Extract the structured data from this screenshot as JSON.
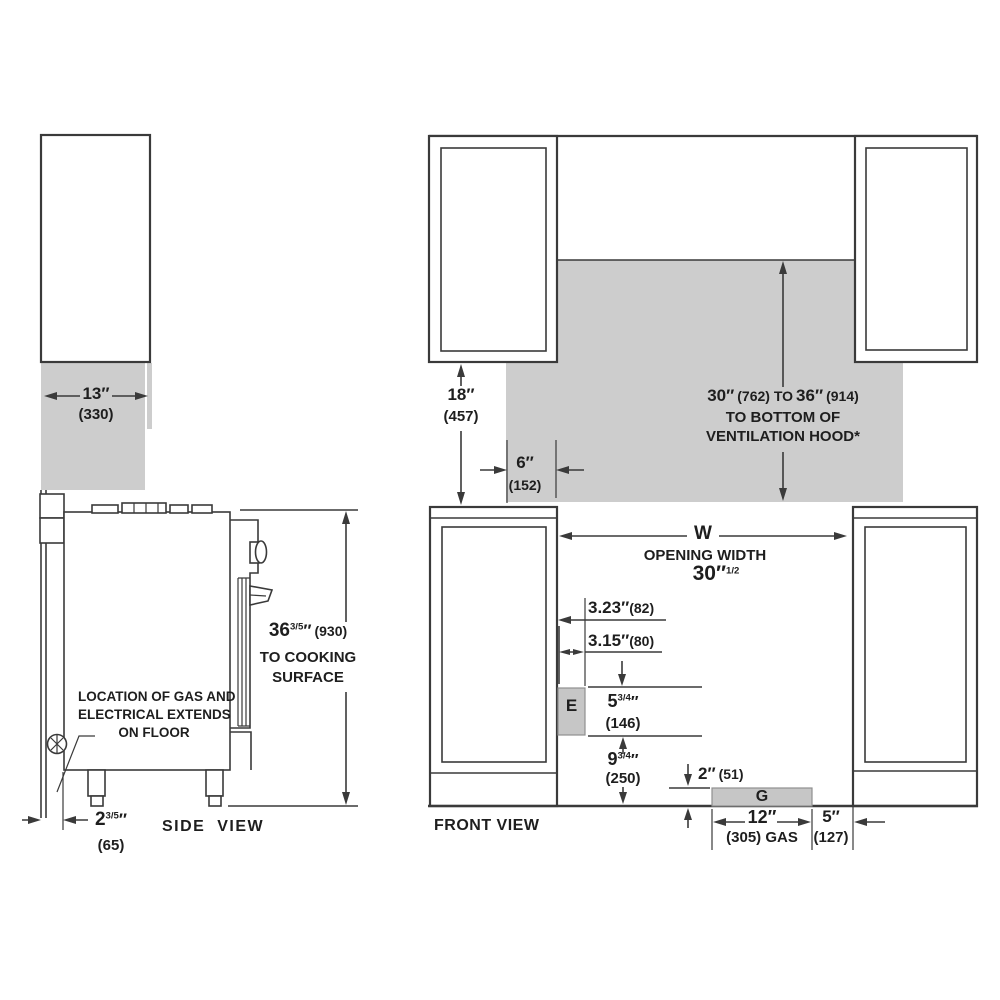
{
  "drawing_title": "range installation clearances",
  "colors": {
    "line": "#3a3a3a",
    "shaded_area": "#cdcdcd",
    "block_fill": "#c6c6c6",
    "text": "#1e1e1e",
    "background": "#ffffff"
  },
  "side": {
    "label": "SIDE  VIEW",
    "dim13": {
      "v": "13″",
      "m": "(330)"
    },
    "dim36": {
      "n": "36",
      "f": "3/5",
      "u": "″",
      "m": "(930)",
      "l2": "TO COOKING",
      "l3": "SURFACE"
    },
    "dim25": {
      "n": "2",
      "f": "3/5",
      "u": "″",
      "m": "(65)"
    },
    "note1": "LOCATION OF GAS AND",
    "note2": "ELECTRICAL EXTENDS",
    "note3": "ON FLOOR"
  },
  "front": {
    "label": "FRONT VIEW",
    "dim18": {
      "v": "18″",
      "m": "(457)"
    },
    "dim6": {
      "v": "6″",
      "m": "(152)"
    },
    "hood": {
      "a": "30″",
      "b": "(762) TO",
      "c": "36″",
      "d": "(914)",
      "l2": "TO BOTTOM OF",
      "l3": "VENTILATION HOOD*"
    },
    "opening": {
      "w": "W",
      "label": "OPENING WIDTH",
      "v": "30″",
      "sup": "1/2"
    },
    "dim323": {
      "v": "3.23″",
      "m": "(82)"
    },
    "dim315": {
      "v": "3.15″",
      "m": "(80)"
    },
    "blockE": "E",
    "blockG": "G",
    "dim534": {
      "n": "5",
      "f": "3/4",
      "u": "″",
      "m": "(146)"
    },
    "dim934": {
      "n": "9",
      "f": "3/4",
      "u": "″",
      "m": "(250)"
    },
    "dim2": {
      "v": "2″",
      "m": "(51)"
    },
    "dim12": {
      "v": "12″",
      "m": "(305) GAS"
    },
    "dim5": {
      "v": "5″",
      "m": "(127)"
    }
  }
}
